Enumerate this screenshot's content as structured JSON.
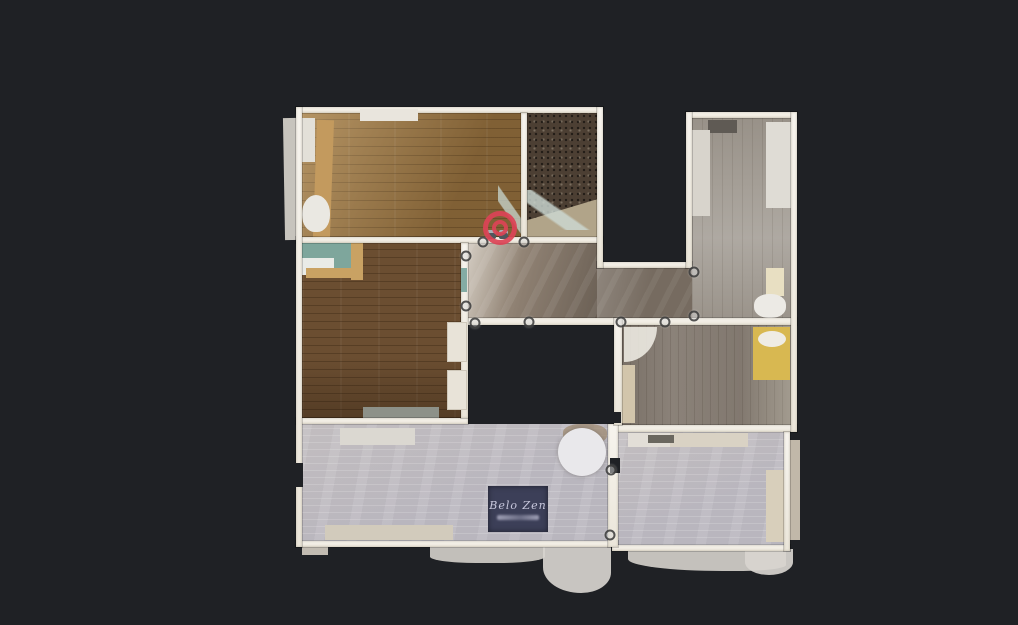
{
  "viewer": {
    "view_label": "floorplan-top-down-view",
    "background_color": "#1f2125",
    "wall_color": "#f2efe8",
    "position_marker": {
      "style": "concentric-red-rings",
      "color": "#dc4356",
      "x": 500,
      "y": 228
    },
    "waypoint_style": "small-translucent-gray-circle",
    "waypoint_count": 12,
    "waypoints": [
      {
        "x": 483,
        "y": 242
      },
      {
        "x": 524,
        "y": 242
      },
      {
        "x": 466,
        "y": 256
      },
      {
        "x": 466,
        "y": 306
      },
      {
        "x": 475,
        "y": 323
      },
      {
        "x": 529,
        "y": 322
      },
      {
        "x": 621,
        "y": 322
      },
      {
        "x": 665,
        "y": 322
      },
      {
        "x": 694,
        "y": 272
      },
      {
        "x": 694,
        "y": 316
      },
      {
        "x": 611,
        "y": 470
      },
      {
        "x": 610,
        "y": 535
      }
    ]
  },
  "logo_mat": {
    "brand": "Belo Zen",
    "tagline_legible": false,
    "mat_color": "#3c3f58",
    "text_color": "#c7c7dc"
  }
}
